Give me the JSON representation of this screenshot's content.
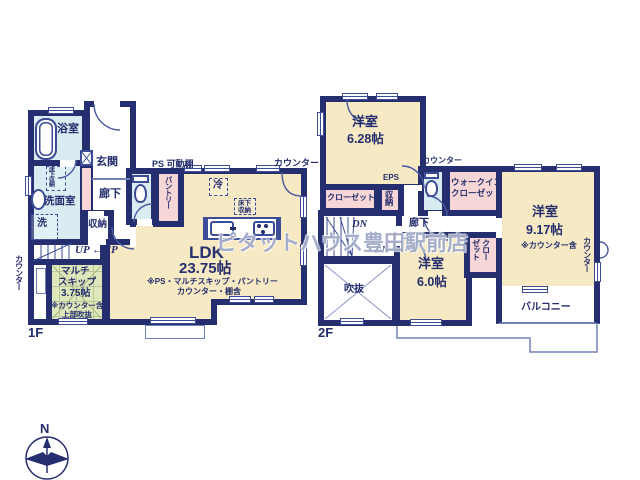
{
  "colors": {
    "wall": "#252e6e",
    "room_cream": "#f6e9c3",
    "room_blue": "#d9ecf2",
    "room_pink": "#f6d6d6",
    "room_green": "#dfe8bb",
    "thin_line": "#7280b8"
  },
  "watermark": "ピタットハウス豊田駅前店",
  "compass": {
    "north_label": "N"
  },
  "floor1": {
    "floor_label": "1F",
    "bath": "浴室",
    "entrance": "玄関",
    "hallway": "廊下",
    "washroom": "洗面室",
    "underfloor_storage": "床下収納",
    "laundry": "洗",
    "storage": "収納",
    "pantry": "パントリー",
    "ps_shelf": "PS 可動棚",
    "fridge": "冷",
    "kitchen_underfloor_line1": "床下",
    "kitchen_underfloor_line2": "収納",
    "counter_top": "カウンター",
    "counter_left": "カウンター",
    "ldk_title": "LDK",
    "ldk_size": "23.75帖",
    "ldk_note_line1": "※PS・マルチスキップ・パントリー",
    "ldk_note_line2": "カウンター・棚含",
    "up_label": "UP",
    "up_arrow_label": "←UP",
    "multi_line1": "マルチ",
    "multi_line2": "スキップ",
    "multi_line3": "3.75帖",
    "multi_line4": "※カウンター含",
    "multi_line5": "上部吹抜"
  },
  "floor2": {
    "floor_label": "2F",
    "room_628_title": "洋室",
    "room_628_size": "6.28帖",
    "eps": "EPS",
    "closet_628": "クローゼット",
    "storage": "収納",
    "counter_toilet": "カウンター",
    "wic_line1": "ウォークイン",
    "wic_line2": "クローゼット",
    "hallway": "廊下",
    "dn1": "DN",
    "dn2": "DN",
    "room_917_title": "洋室",
    "room_917_size": "9.17帖",
    "room_917_note": "※カウンター含",
    "counter_right": "カウンター",
    "closet_60_col1": "クロー",
    "closet_60_col2": "ゼット",
    "room_60_title": "洋室",
    "room_60_size": "6.0帖",
    "void": "吹抜",
    "balcony": "バルコニー"
  }
}
